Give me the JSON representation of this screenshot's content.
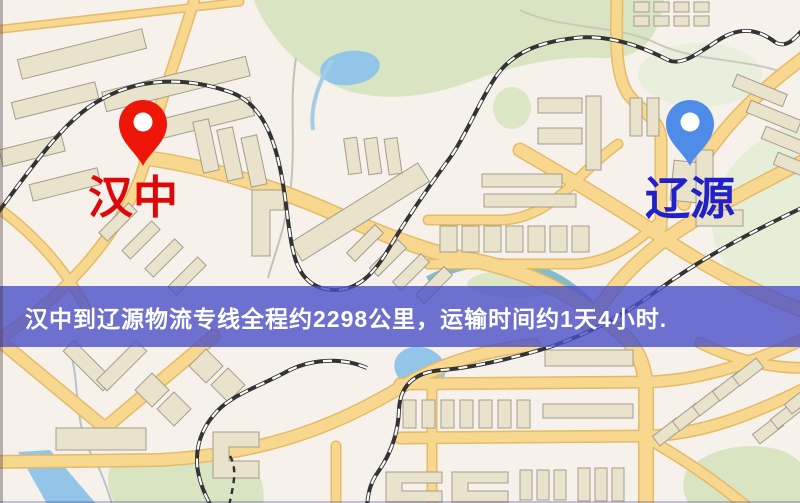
{
  "banner": {
    "text": "汉中到辽源物流专线全程约2298公里，运输时间约1天4小时.",
    "background_color": "#4a50c8",
    "text_color": "#ffffff"
  },
  "markers": {
    "origin": {
      "label": "汉中",
      "pin_color": "#ed1608",
      "label_color": "#dd0909"
    },
    "destination": {
      "label": "辽源",
      "pin_color": "#4f8ce8",
      "label_color": "#2121cc"
    }
  },
  "map": {
    "background_color": "#f7f1ec",
    "road_fill_color": "#f7d88e",
    "road_casing_color": "#e5ba68",
    "building_color": "#eae3cc",
    "building_outline_color": "#a39d8f",
    "park_color": "#d9e5c2",
    "park_light_color": "#e6eed8",
    "water_color": "#92c5e8",
    "railway_color": "#333333"
  }
}
